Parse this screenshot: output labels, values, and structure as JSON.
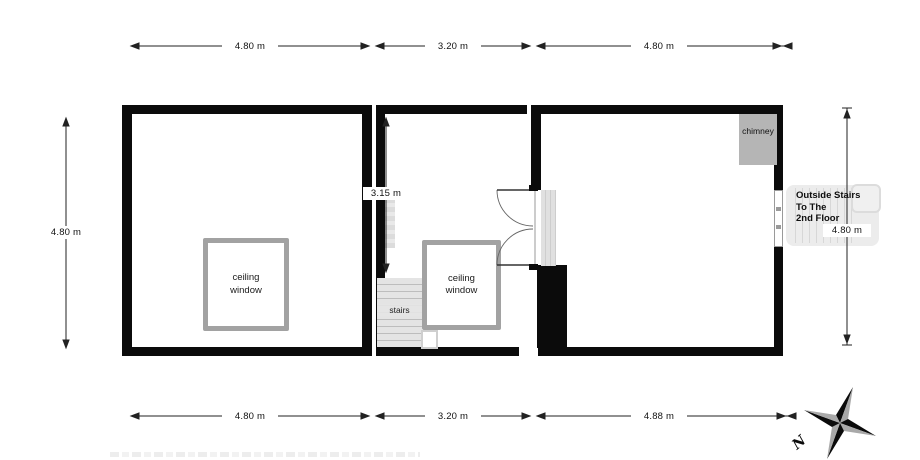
{
  "dimensions": {
    "top_left": "4.80 m",
    "top_middle": "3.20 m",
    "top_right": "4.80 m",
    "bottom_left": "4.80 m",
    "bottom_middle": "3.20 m",
    "bottom_right": "4.88 m",
    "left_side": "4.80 m",
    "right_side": "4.80 m",
    "middle_room_depth": "3.15 m"
  },
  "rooms": {
    "left": {
      "ceiling_window": "ceiling\nwindow"
    },
    "middle": {
      "ceiling_window": "ceiling\nwindow",
      "stairs": "stairs"
    },
    "right": {
      "chimney": "chimney"
    }
  },
  "outside_stairs": {
    "lines": [
      "Outside Stairs",
      "To The",
      "2nd Floor"
    ]
  },
  "compass": {
    "north": "N"
  },
  "colors": {
    "wall": "#0b0b0b",
    "chimney_fill": "#b5b5b5",
    "ceiling_window_frame": "#a2a2a2",
    "stairs_fill": "#e4e4e4",
    "compass_light": "#a9a9a9"
  }
}
